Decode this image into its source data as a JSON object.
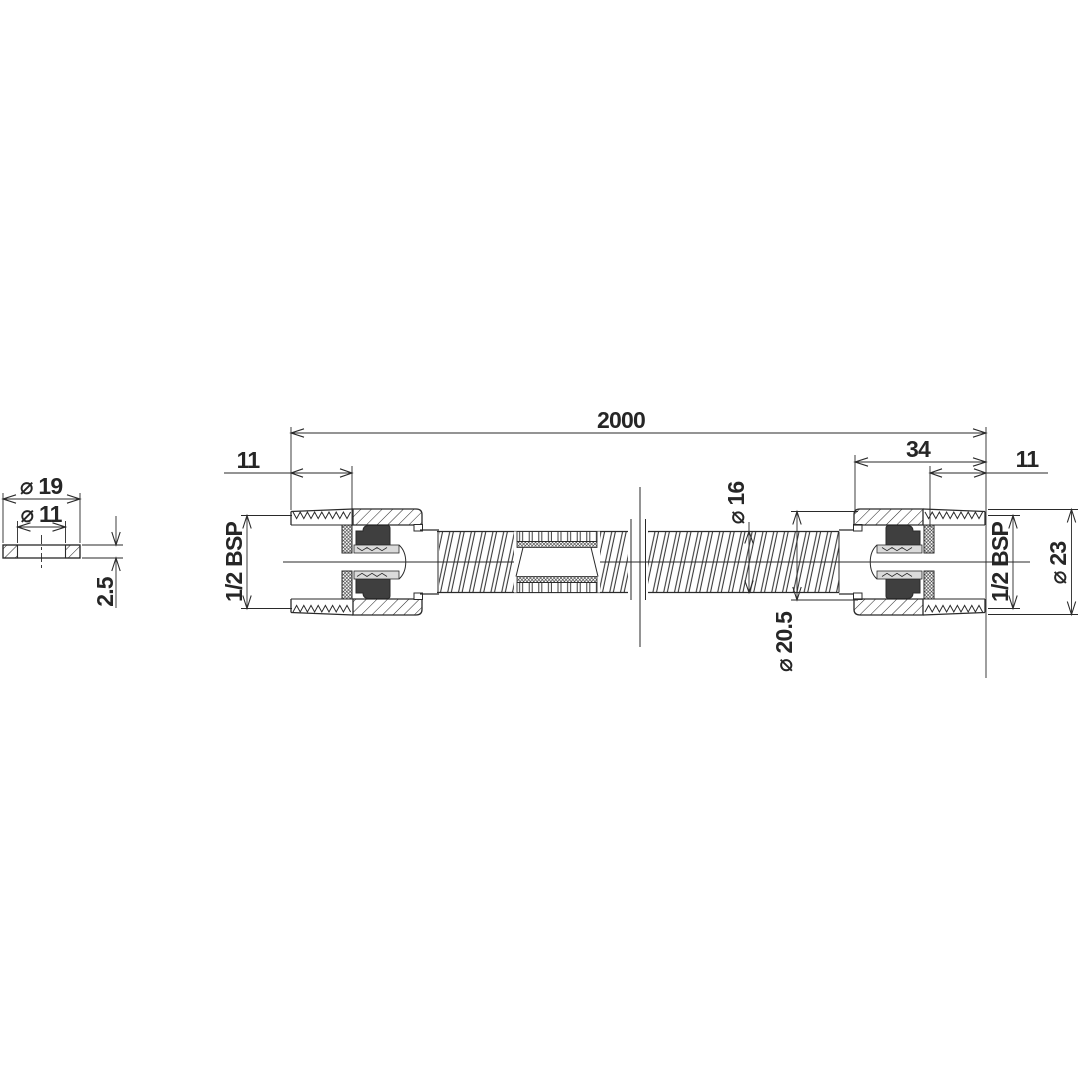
{
  "drawing": {
    "title_note": "",
    "colors": {
      "line": "#2a2a2a",
      "dark_fill": "#3f3f3f",
      "light_fill": "#dadada",
      "background": "#ffffff"
    },
    "main_view": {
      "dims": {
        "overall_length": "2000",
        "left_thread_length": "11",
        "right_fitting_length": "34",
        "right_thread_length": "11",
        "left_thread_size": "1/2 BSP",
        "right_thread_size": "1/2 BSP",
        "hose_outer_dia": "⌀ 16",
        "sleeve_outer_dia": "⌀ 20.5",
        "nut_outer_dia": "⌀ 23"
      }
    },
    "washer_view": {
      "dims": {
        "outer_dia": "⌀ 19",
        "inner_dia": "⌀ 11",
        "thickness": "2.5"
      }
    }
  }
}
